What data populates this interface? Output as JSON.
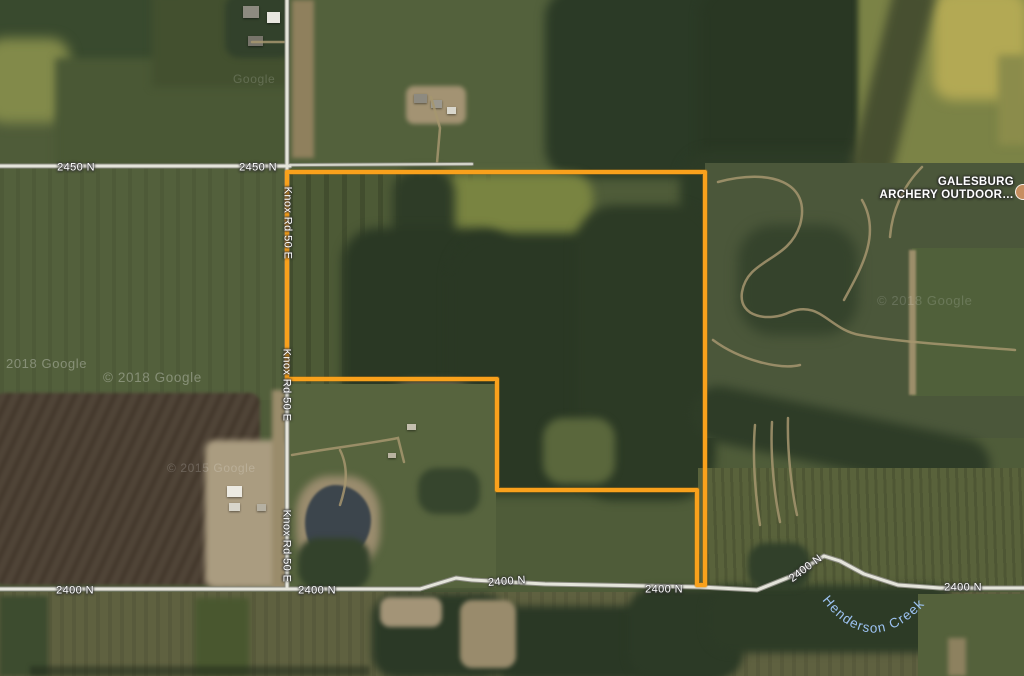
{
  "map": {
    "view_type": "satellite"
  },
  "labels": {
    "road_2450": [
      "2450 N",
      "2450 N"
    ],
    "road_2400": [
      "2400 N",
      "2400 N",
      "2400 N",
      "2400 N",
      "2400 N",
      "2400 N"
    ],
    "road_knox": [
      "Knox Rd 50 E",
      "Knox Rd 50 E",
      "Knox Rd 50 E"
    ]
  },
  "poi": {
    "name_line1": "GALESBURG",
    "name_line2": "ARCHERY OUTDOOR…"
  },
  "water": {
    "creek_name": "Henderson Creek"
  },
  "watermarks": [
    "Google",
    "2018 Google",
    "© 2018 Google",
    "© 2015 Google",
    "© 2018 Google"
  ],
  "parcel": {
    "outline_color": "#F9A11C",
    "points_attr": "287,172 705,172 705,585 697,585 697,490 497,490 497,379 287,379"
  },
  "colors": {
    "parcel_outline": "#F9A11C",
    "road_fill": "#E4E4DA",
    "road_casing": "#8A8A80",
    "water_label": "#9CC2F2",
    "label_text": "#FFFFFF",
    "label_halo": "#373737",
    "woods": "#2B3926",
    "field_green": "#4F5C39",
    "field_brown": "#4A3E31"
  }
}
